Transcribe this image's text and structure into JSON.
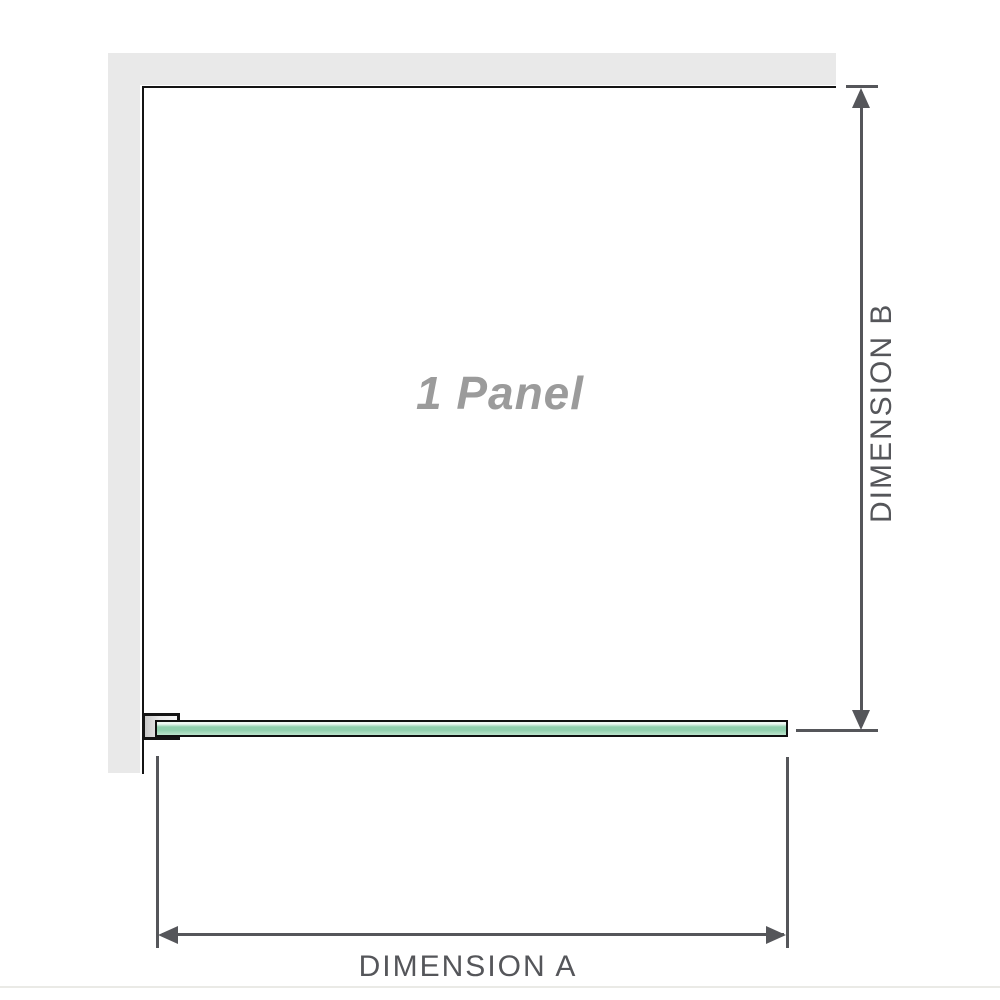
{
  "diagram": {
    "title": "shower panel dimension diagram",
    "labels": {
      "panel": "1 Panel",
      "dimension_a": "DIMENSION A",
      "dimension_b": "DIMENSION B"
    }
  },
  "colors": {
    "wall": "#e9e9e9",
    "outline": "#141414",
    "dimension": "#55565a",
    "glass_light": "#edf8f2",
    "glass_main": "#90cfad",
    "glass_soft": "#bce5cd",
    "panel_label_color": "#9b9b9b"
  }
}
